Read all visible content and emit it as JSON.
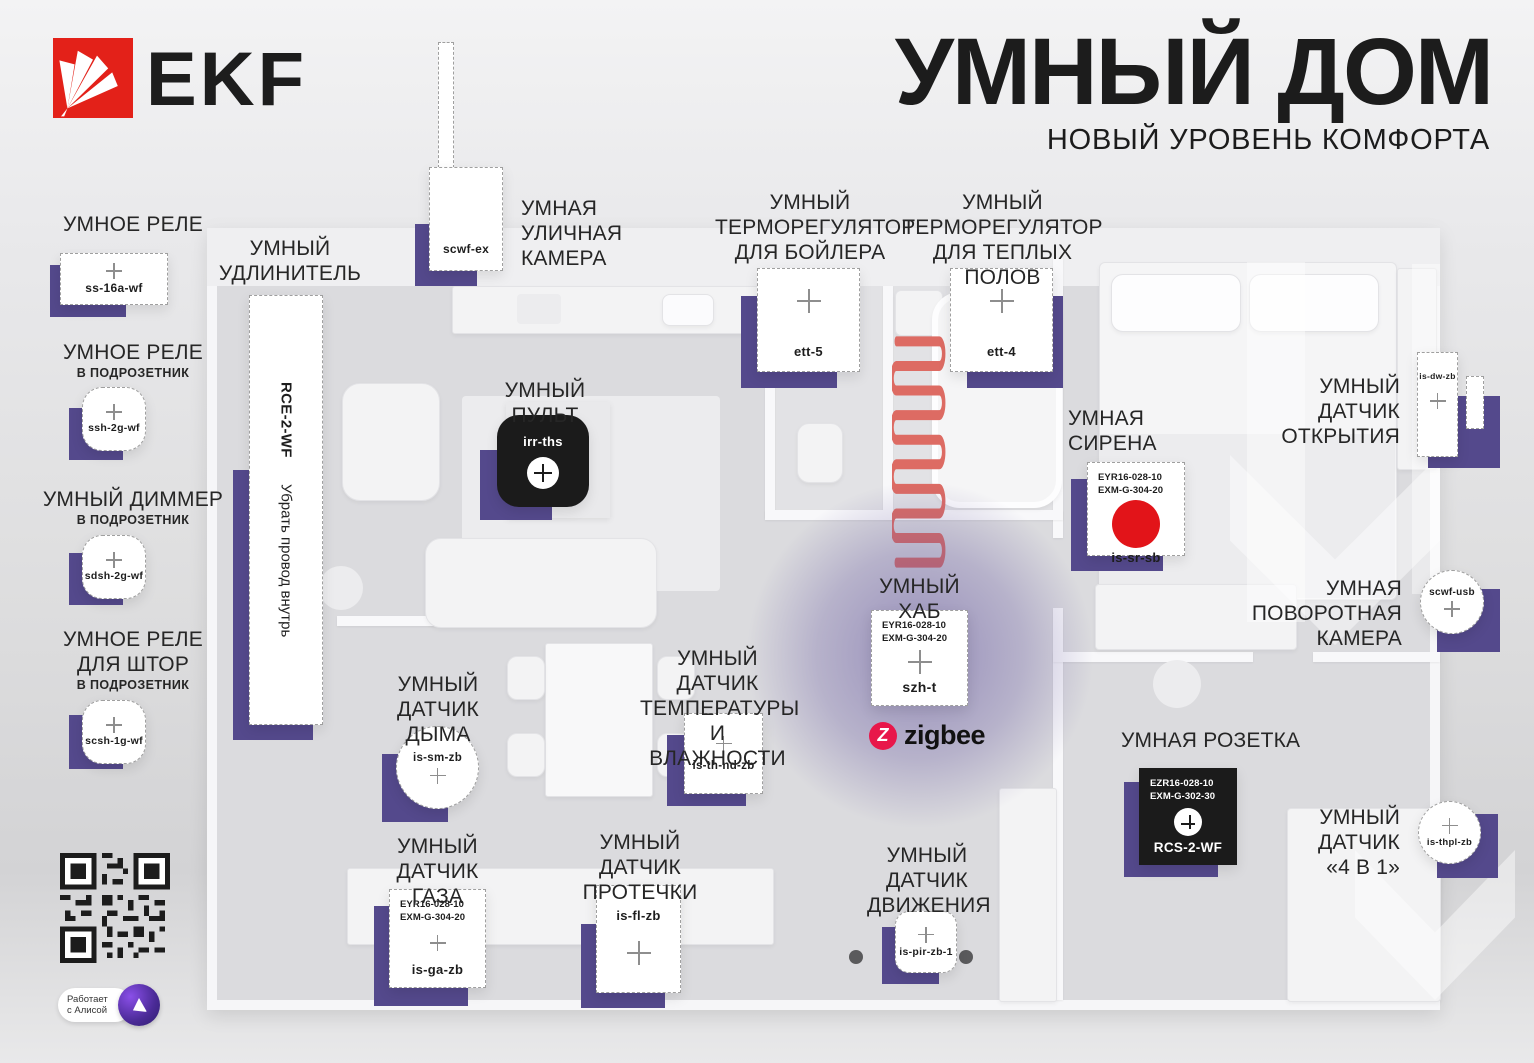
{
  "brand": {
    "logo_text": "EKF"
  },
  "header": {
    "title": "УМНЫЙ ДОМ",
    "subtitle": "НОВЫЙ УРОВЕНЬ КОМФОРТА"
  },
  "colors": {
    "accent_purple": "#54498C",
    "brand_red": "#E32119",
    "siren_red": "#E21419",
    "zigbee_red": "#E8174A",
    "coil_red": "#DD6B63"
  },
  "sidebar": {
    "relay": {
      "title": "УМНОЕ РЕЛЕ",
      "model": "ss-16a-wf"
    },
    "relay_flush": {
      "title": "УМНОЕ РЕЛЕ",
      "subtitle": "В ПОДРОЗЕТНИК",
      "model": "ssh-2g-wf"
    },
    "dimmer_flush": {
      "title": "УМНЫЙ ДИММЕР",
      "subtitle": "В ПОДРОЗЕТНИК",
      "model": "sdsh-2g-wf"
    },
    "curtain_relay": {
      "title": "УМНОЕ РЕЛЕ",
      "title2": "ДЛЯ ШТОР",
      "subtitle": "В ПОДРОЗЕТНИК",
      "model": "scsh-1g-wf"
    },
    "alice": {
      "line1": "Работает",
      "line2": "с Алисой"
    }
  },
  "devices": {
    "extension": {
      "label1": "УМНЫЙ",
      "label2": "УДЛИНИТЕЛЬ",
      "model": "RCE-2-WF",
      "note": "Убрать провод внутрь"
    },
    "outdoor_camera": {
      "label1": "УМНАЯ",
      "label2": "УЛИЧНАЯ",
      "label3": "КАМЕРА",
      "model": "scwf-ex"
    },
    "boiler_thermostat": {
      "label1": "УМНЫЙ",
      "label2": "ТЕРМОРЕГУЛЯТОР",
      "label3": "ДЛЯ БОЙЛЕРА",
      "model": "ett-5"
    },
    "floor_thermostat": {
      "label1": "УМНЫЙ",
      "label2": "ТЕРМОРЕГУЛЯТОР",
      "label3": "ДЛЯ ТЕПЛЫХ ПОЛОВ",
      "model": "ett-4"
    },
    "remote": {
      "label1": "УМНЫЙ ПУЛЬТ",
      "model": "irr-ths"
    },
    "siren": {
      "label1": "УМНАЯ",
      "label2": "СИРЕНА",
      "pn1": "EYR16-028-10",
      "pn2": "EXM-G-304-20",
      "model": "is-sr-sb"
    },
    "door_sensor": {
      "label1": "УМНЫЙ",
      "label2": "ДАТЧИК",
      "label3": "ОТКРЫТИЯ",
      "model": "is-dw-zb"
    },
    "hub": {
      "label1": "УМНЫЙ ХАБ",
      "pn1": "EYR16-028-10",
      "pn2": "EXM-G-304-20",
      "model": "szh-t",
      "badge": "zigbee"
    },
    "ptz_camera": {
      "label1": "УМНАЯ",
      "label2": "ПОВОРОТНАЯ",
      "label3": "КАМЕРА",
      "model": "scwf-usb"
    },
    "smoke_sensor": {
      "label1": "УМНЫЙ",
      "label2": "ДАТЧИК ДЫМА",
      "model": "is-sm-zb"
    },
    "temp_sensor": {
      "label1": "УМНЫЙ ДАТЧИК",
      "label2": "ТЕМПЕРАТУРЫ",
      "label3": "И ВЛАЖНОСТИ",
      "model": "is-th-nd-zb"
    },
    "socket": {
      "label1": "УМНАЯ РОЗЕТКА",
      "pn1": "EZR16-028-10",
      "pn2": "EXM-G-302-30",
      "model": "RCS-2-WF"
    },
    "gas_sensor": {
      "label1": "УМНЫЙ",
      "label2": "ДАТЧИК ГАЗА",
      "pn1": "EYR16-028-10",
      "pn2": "EXM-G-304-20",
      "model": "is-ga-zb"
    },
    "leak_sensor": {
      "label1": "УМНЫЙ",
      "label2": "ДАТЧИК ПРОТЕЧКИ",
      "model": "is-fl-zb"
    },
    "motion_sensor": {
      "label1": "УМНЫЙ",
      "label2": "ДАТЧИК",
      "label3": "ДВИЖЕНИЯ",
      "model": "is-pir-zb-1"
    },
    "multi_sensor": {
      "label1": "УМНЫЙ",
      "label2": "ДАТЧИК",
      "label3": "«4 В 1»",
      "model": "is-thpl-zb"
    }
  }
}
